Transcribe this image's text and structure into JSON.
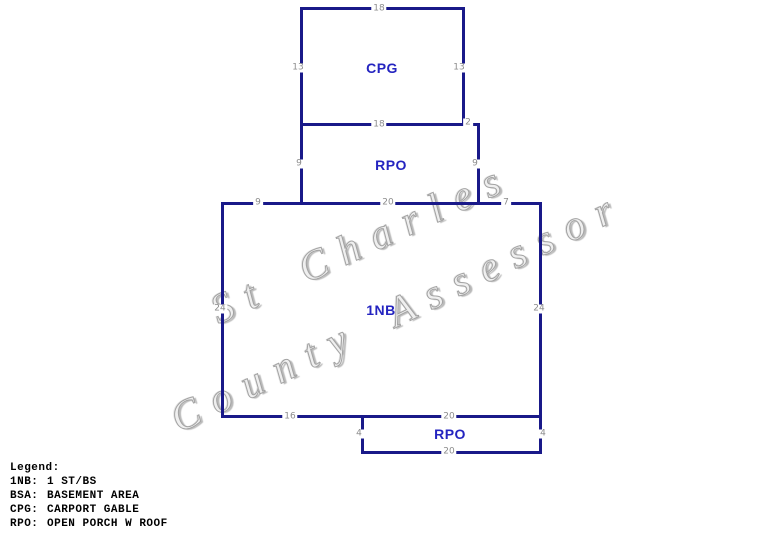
{
  "watermark": {
    "line1": "St Charles",
    "line2": "County Assessor"
  },
  "sketch": {
    "colors": {
      "outline": "#191989",
      "area_label": "#2424c0",
      "dimension_text": "#8c8c8c",
      "watermark": "#a3a3a3",
      "background": "#ffffff"
    },
    "areas": {
      "cpg": {
        "label": "CPG"
      },
      "rpo_upper": {
        "label": "RPO"
      },
      "main": {
        "label": "1NB"
      },
      "rpo_lower": {
        "label": "RPO"
      }
    },
    "dims": {
      "cpg_top": "18",
      "cpg_left": "13",
      "cpg_right": "13",
      "cpg_bottom": "18",
      "cpg_offset": "2",
      "rpo_upper_left": "9",
      "rpo_upper_right": "9",
      "main_top_left": "9",
      "main_top_mid": "20",
      "main_top_right": "7",
      "main_left": "24",
      "main_right": "24",
      "main_bottom_left": "16",
      "main_bottom_right": "20",
      "rpo_lower_left": "4",
      "rpo_lower_right": "4",
      "rpo_lower_bottom": "20"
    }
  },
  "legend": {
    "title": "Legend:",
    "entries": [
      {
        "code": "1NB:",
        "desc": "1 ST/BS"
      },
      {
        "code": "BSA:",
        "desc": "BASEMENT AREA"
      },
      {
        "code": "CPG:",
        "desc": "CARPORT GABLE"
      },
      {
        "code": "RPO:",
        "desc": "OPEN PORCH W ROOF"
      }
    ]
  }
}
